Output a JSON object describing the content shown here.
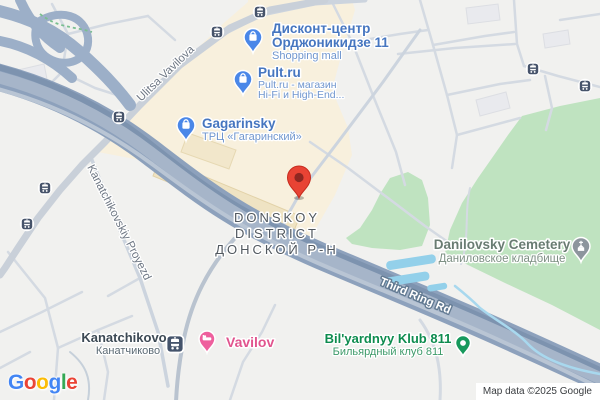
{
  "map": {
    "attribution": "Map data ©2025 Google",
    "logo": {
      "letters": [
        "G",
        "o",
        "o",
        "g",
        "l",
        "e"
      ]
    },
    "district": {
      "line1": "DONSKOY",
      "line2": "DISTRICT",
      "line3": "ДОНСКОЙ Р-Н"
    },
    "streets": {
      "vavilova": "Ulitsa Vavilova",
      "kanatchikovsky": "Kanatchikovskiy Proyezd",
      "third_ring": "Third Ring Rd"
    },
    "pois": {
      "diskont": {
        "name1": "Дисконт-центр",
        "name2": "Орджоникидзе 11",
        "category": "Shopping mall"
      },
      "pult": {
        "name": "Pult.ru",
        "desc1": "Pult.ru - магазин",
        "desc2": "Hi-Fi и High-End..."
      },
      "gagarinsky": {
        "name": "Gagarinsky",
        "desc": "ТРЦ «Гагаринский»"
      },
      "cemetery": {
        "name": "Danilovsky Cemetery",
        "name_ru": "Даниловское кладбище"
      },
      "bilyard": {
        "name": "Bil'yardnyy Klub 811",
        "name_ru": "Бильярдный клуб 811"
      },
      "kanatchikovo": {
        "name": "Kanatchikovo",
        "name_ru": "Канатчиково"
      },
      "vavilov": {
        "name": "Vavilov"
      }
    },
    "colors": {
      "land": "#f1f1ef",
      "commercial_area": "#f8f0dd",
      "cemetery_green": "#bfe3c0",
      "water_blue": "#93d0ea",
      "highway": "#8da1bc",
      "poi_blue": "#4676c0",
      "poi_green": "#0e8c4f",
      "poi_pink": "#e1548e",
      "district_gray": "#51585f",
      "marker_red": "#e84334",
      "transit_slate": "#46536a",
      "logo_letter_colors": [
        "#4285F4",
        "#EA4335",
        "#FBBC05",
        "#4285F4",
        "#34A853",
        "#EA4335"
      ]
    }
  }
}
